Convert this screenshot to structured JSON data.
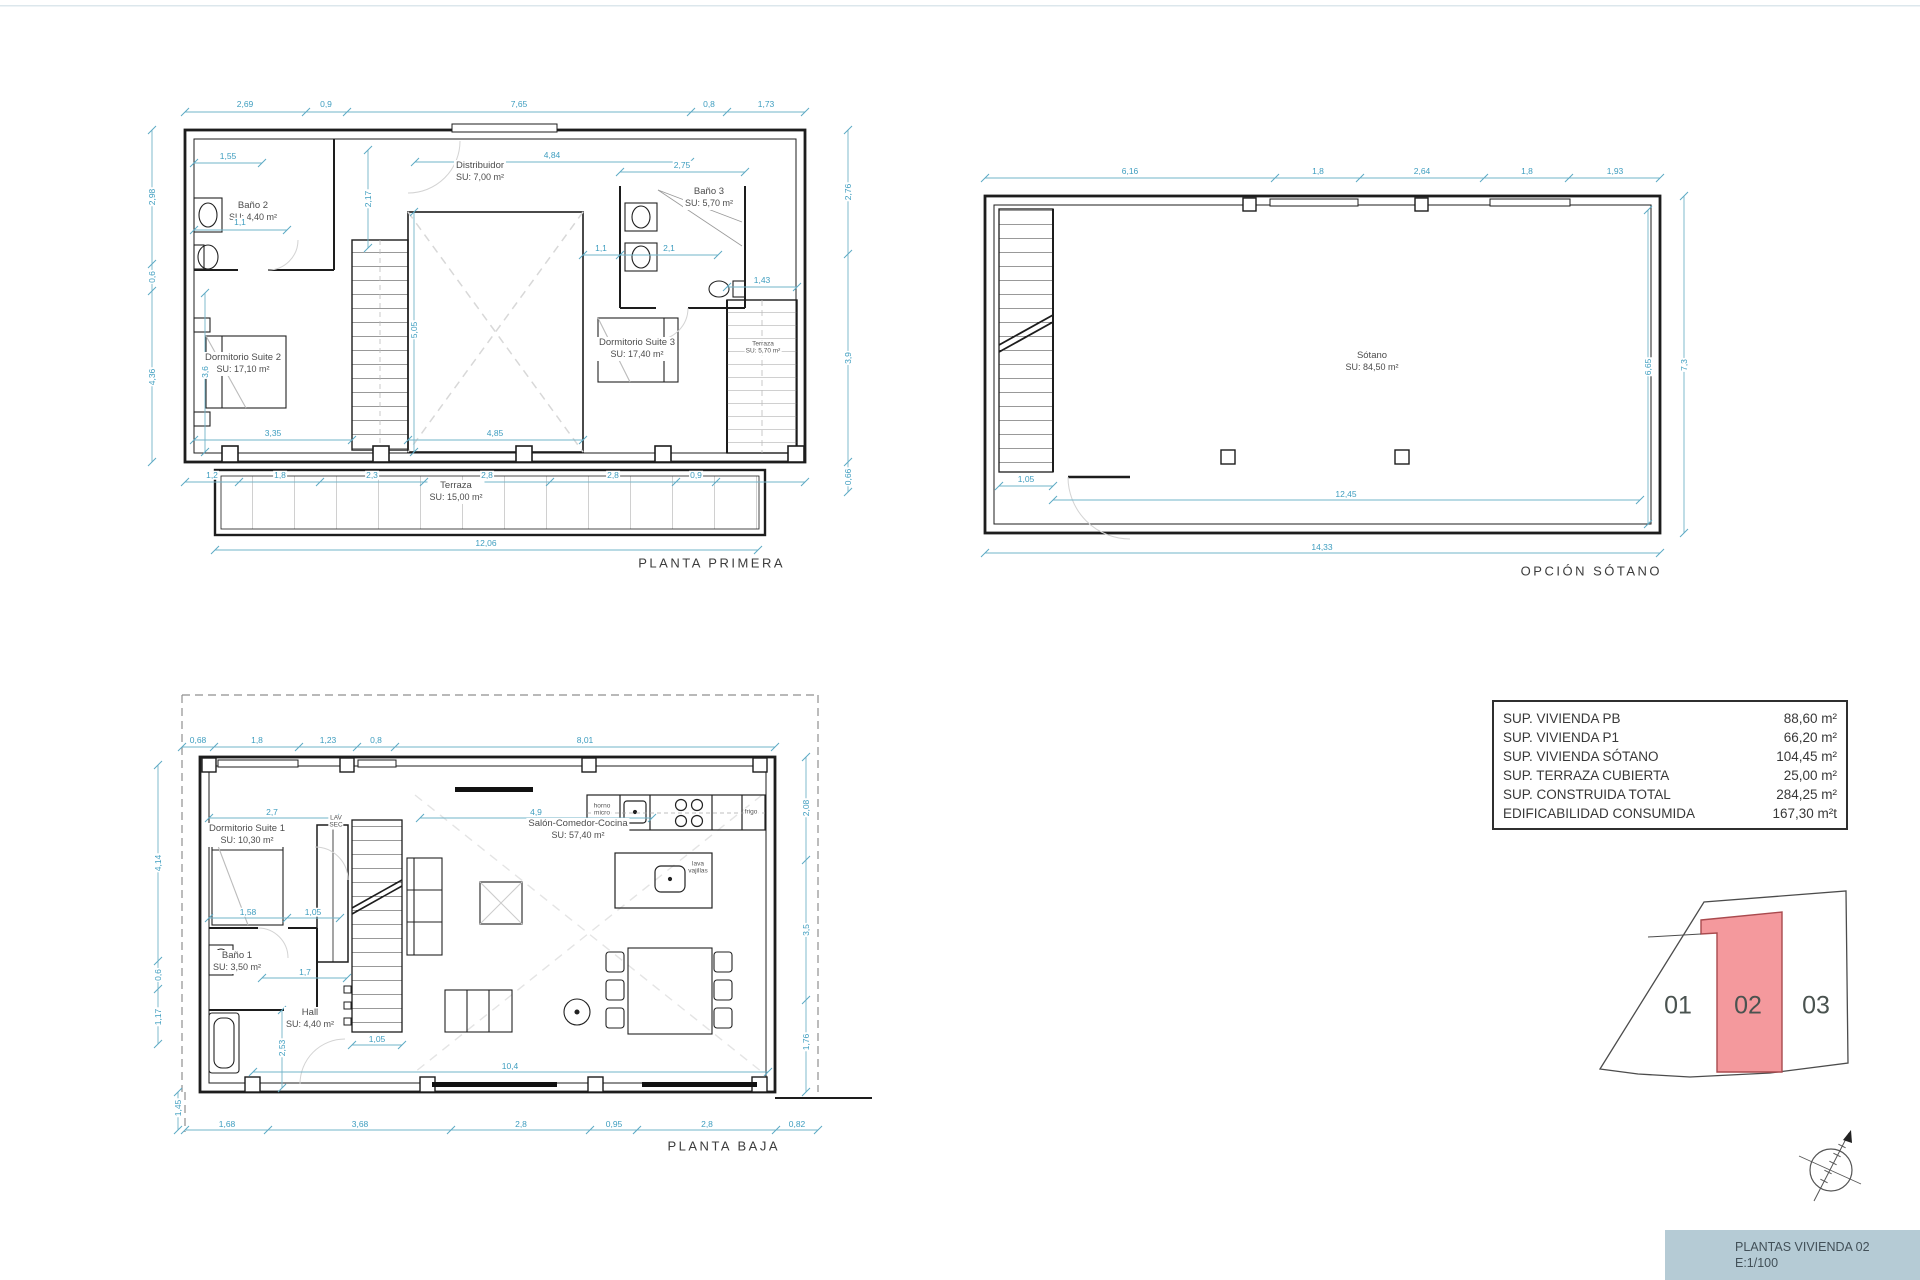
{
  "colors": {
    "wall": "#1d1d1d",
    "dimension": "#3e9dbf",
    "room_label": "#4c4c4c",
    "dashed_guides": "#d8d8d8",
    "parcel_highlight_fill": "#f4999d",
    "parcel_highlight_stroke": "#a94a4e",
    "title_block_bg": "#b5cbd5"
  },
  "plans": [
    {
      "id": "planta-primera",
      "title": "PLANTA PRIMERA",
      "title_x": 785,
      "title_y": 563,
      "rooms": [
        {
          "name": "Baño 2",
          "area": "SU: 4,40 m²",
          "x": 253,
          "y": 212
        },
        {
          "name": "Distribuidor",
          "area": "SU: 7,00 m²",
          "x": 480,
          "y": 172
        },
        {
          "name": "Baño 3",
          "area": "SU: 5,70 m²",
          "x": 709,
          "y": 198
        },
        {
          "name": "Dormitorio Suite 2",
          "area": "SU: 17,10 m²",
          "x": 243,
          "y": 364
        },
        {
          "name": "Dormitorio Suite 3",
          "area": "SU: 17,40 m²",
          "x": 637,
          "y": 349
        },
        {
          "name": "Terraza",
          "area": "SU: 5,70 m²",
          "x": 763,
          "y": 348,
          "small": true
        },
        {
          "name": "Terraza",
          "area": "SU: 15,00 m²",
          "x": 456,
          "y": 492
        }
      ],
      "dims": [
        [
          "2,69",
          245,
          104
        ],
        [
          "0,9",
          326,
          104
        ],
        [
          "7,65",
          519,
          104
        ],
        [
          "0,8",
          709,
          104
        ],
        [
          "1,73",
          766,
          104
        ],
        [
          "2,98",
          152,
          197,
          1
        ],
        [
          "0,6",
          152,
          277,
          1
        ],
        [
          "4,36",
          152,
          377,
          1
        ],
        [
          "2,76",
          848,
          192,
          1
        ],
        [
          "3,9",
          848,
          358,
          1
        ],
        [
          "0,66",
          848,
          477,
          1
        ],
        [
          "1,55",
          228,
          156
        ],
        [
          "1,1",
          240,
          222
        ],
        [
          "2,17",
          368,
          199,
          1
        ],
        [
          "3,6",
          205,
          372,
          1
        ],
        [
          "4,84",
          552,
          155
        ],
        [
          "2,75",
          682,
          165
        ],
        [
          "1,43",
          762,
          280
        ],
        [
          "1,1",
          601,
          248
        ],
        [
          "2,1",
          669,
          248
        ],
        [
          "3,35",
          273,
          433
        ],
        [
          "4,85",
          495,
          433
        ],
        [
          "5,05",
          414,
          330,
          1
        ],
        [
          "1,2",
          212,
          475
        ],
        [
          "1,8",
          280,
          475
        ],
        [
          "2,3",
          372,
          475
        ],
        [
          "2,8",
          487,
          475
        ],
        [
          "2,8",
          613,
          475
        ],
        [
          "0,9",
          696,
          475
        ],
        [
          "12,06",
          486,
          543
        ]
      ]
    },
    {
      "id": "opcion-sotano",
      "title": "OPCIÓN SÓTANO",
      "title_x": 1662,
      "title_y": 571,
      "rooms": [
        {
          "name": "Sótano",
          "area": "SU: 84,50 m²",
          "x": 1372,
          "y": 362
        }
      ],
      "dims": [
        [
          "6,16",
          1130,
          171
        ],
        [
          "1,8",
          1318,
          171
        ],
        [
          "2,64",
          1422,
          171
        ],
        [
          "1,8",
          1527,
          171
        ],
        [
          "1,93",
          1615,
          171
        ],
        [
          "7,3",
          1684,
          365,
          1
        ],
        [
          "6,65",
          1648,
          367,
          1
        ],
        [
          "12,45",
          1346,
          494
        ],
        [
          "1,05",
          1026,
          479
        ],
        [
          "14,33",
          1322,
          547
        ]
      ]
    },
    {
      "id": "planta-baja",
      "title": "PLANTA BAJA",
      "title_x": 780,
      "title_y": 1146,
      "rooms": [
        {
          "name": "Dormitorio Suite 1",
          "area": "SU: 10,30 m²",
          "x": 247,
          "y": 835
        },
        {
          "name": "Baño 1",
          "area": "SU: 3,50 m²",
          "x": 237,
          "y": 962
        },
        {
          "name": "Hall",
          "area": "SU: 4,40 m²",
          "x": 310,
          "y": 1019
        },
        {
          "name": "Salón-Comedor-Cocina",
          "area": "SU: 57,40 m²",
          "x": 578,
          "y": 830
        },
        {
          "name": "LAV",
          "area": "SEC",
          "x": 336,
          "y": 822,
          "small": true
        },
        {
          "name": "horno",
          "area": "micro",
          "x": 602,
          "y": 810,
          "small": true
        },
        {
          "name": "frigo",
          "area": "",
          "x": 751,
          "y": 812,
          "small": true
        },
        {
          "name": "lava",
          "area": "vajillas",
          "x": 698,
          "y": 868,
          "small": true
        }
      ],
      "dims": [
        [
          "0,68",
          198,
          740
        ],
        [
          "1,8",
          257,
          740
        ],
        [
          "1,23",
          328,
          740
        ],
        [
          "0,8",
          376,
          740
        ],
        [
          "8,01",
          585,
          740
        ],
        [
          "4,14",
          158,
          863,
          1
        ],
        [
          "0,6",
          158,
          975,
          1
        ],
        [
          "1,17",
          158,
          1017,
          1
        ],
        [
          "1,45",
          178,
          1108,
          1
        ],
        [
          "2,08",
          806,
          808,
          1
        ],
        [
          "3,5",
          806,
          930,
          1
        ],
        [
          "1,76",
          806,
          1042,
          1
        ],
        [
          "2,7",
          272,
          812
        ],
        [
          "4,9",
          536,
          812
        ],
        [
          "1,58",
          248,
          912
        ],
        [
          "1,05",
          313,
          912
        ],
        [
          "1,7",
          305,
          972
        ],
        [
          "2,53",
          282,
          1048,
          1
        ],
        [
          "1,05",
          377,
          1039
        ],
        [
          "10,4",
          510,
          1066
        ],
        [
          "1,68",
          227,
          1124
        ],
        [
          "3,68",
          360,
          1124
        ],
        [
          "2,8",
          521,
          1124
        ],
        [
          "0,95",
          614,
          1124
        ],
        [
          "2,8",
          707,
          1124
        ],
        [
          "0,82",
          797,
          1124
        ]
      ]
    }
  ],
  "summary_table": {
    "rows": [
      {
        "label": "SUP. VIVIENDA PB",
        "value": "88,60 m²"
      },
      {
        "label": "SUP. VIVIENDA P1",
        "value": "66,20 m²"
      },
      {
        "label": "SUP. VIVIENDA SÓTANO",
        "value": "104,45 m²"
      },
      {
        "label": "SUP. TERRAZA CUBIERTA",
        "value": "25,00 m²"
      },
      {
        "label": "SUP. CONSTRUIDA TOTAL",
        "value": "284,25 m²"
      },
      {
        "label": "EDIFICABILIDAD CONSUMIDA",
        "value": "167,30 m²t"
      }
    ]
  },
  "site_plan": {
    "units": [
      {
        "label": "01",
        "x": 1678,
        "y": 1006,
        "highlighted": false
      },
      {
        "label": "02",
        "x": 1748,
        "y": 1006,
        "highlighted": true
      },
      {
        "label": "03",
        "x": 1816,
        "y": 1006,
        "highlighted": false
      }
    ]
  },
  "icons": {
    "compass": "north-compass"
  },
  "title_block": {
    "line1": "PLANTAS VIVIENDA 02",
    "line2": "E:1/100"
  }
}
